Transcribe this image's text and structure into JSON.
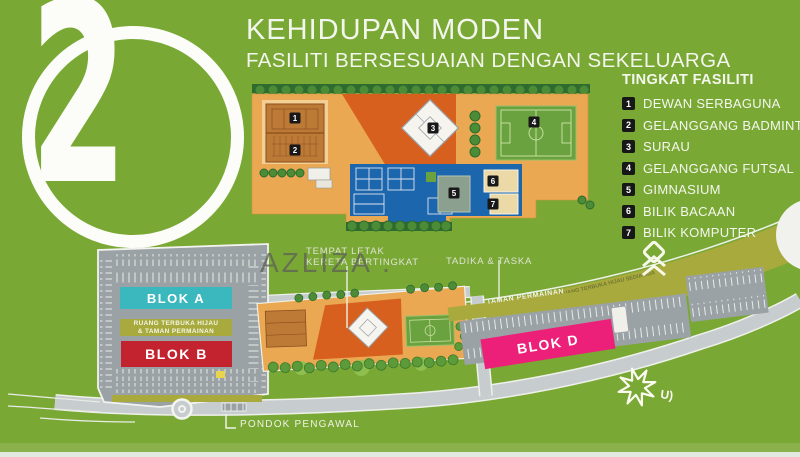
{
  "slide_number": "2",
  "header": {
    "title": "KEHIDUPAN MODEN",
    "subtitle": "FASILITI BERSESUAIAN DENGAN SEKELUARGA"
  },
  "legend": {
    "title": "TINGKAT FASILITI",
    "items": [
      {
        "num": "1",
        "label": "DEWAN SERBAGUNA"
      },
      {
        "num": "2",
        "label": "GELANGGANG BADMINTON"
      },
      {
        "num": "3",
        "label": "SURAU"
      },
      {
        "num": "4",
        "label": "GELANGGANG FUTSAL"
      },
      {
        "num": "5",
        "label": "GIMNASIUM"
      },
      {
        "num": "6",
        "label": "BILIK BACAAN"
      },
      {
        "num": "7",
        "label": "BILIK KOMPUTER"
      }
    ]
  },
  "site_plan": {
    "blocks": {
      "blok_a": {
        "label": "BLOK A",
        "color": "#3ab8bd"
      },
      "blok_b": {
        "label": "BLOK B",
        "color": "#c3232f"
      },
      "blok_d": {
        "label": "BLOK D",
        "color": "#ec2078"
      }
    },
    "open_space": {
      "line1": "RUANG TERBUKA HIJAU",
      "line2": "& TAMAN PERMAINAN"
    },
    "labels": {
      "parking_line1": "TEMPAT LETAK",
      "parking_line2": "KERETA BERTINGKAT",
      "tadika": "TADIKA & TASKA",
      "taman_permainan": "TAMAN PERMAINAN",
      "guard_house": "PONDOK PENGAWAL",
      "green_reserve": "RUANG TERBUKA HIJAU SEDIA ADA"
    },
    "watermark": "AZLIZA .",
    "signature": "U)"
  },
  "colors": {
    "background": "#7aa835",
    "accent_teal": "#3ab8bd",
    "accent_red": "#c3232f",
    "accent_pink": "#ec2078",
    "olive": "#a8aa3e",
    "podium_orange": "#e9a851",
    "court_red_orange": "#d8601f",
    "pool_blue": "#1b66ad"
  }
}
